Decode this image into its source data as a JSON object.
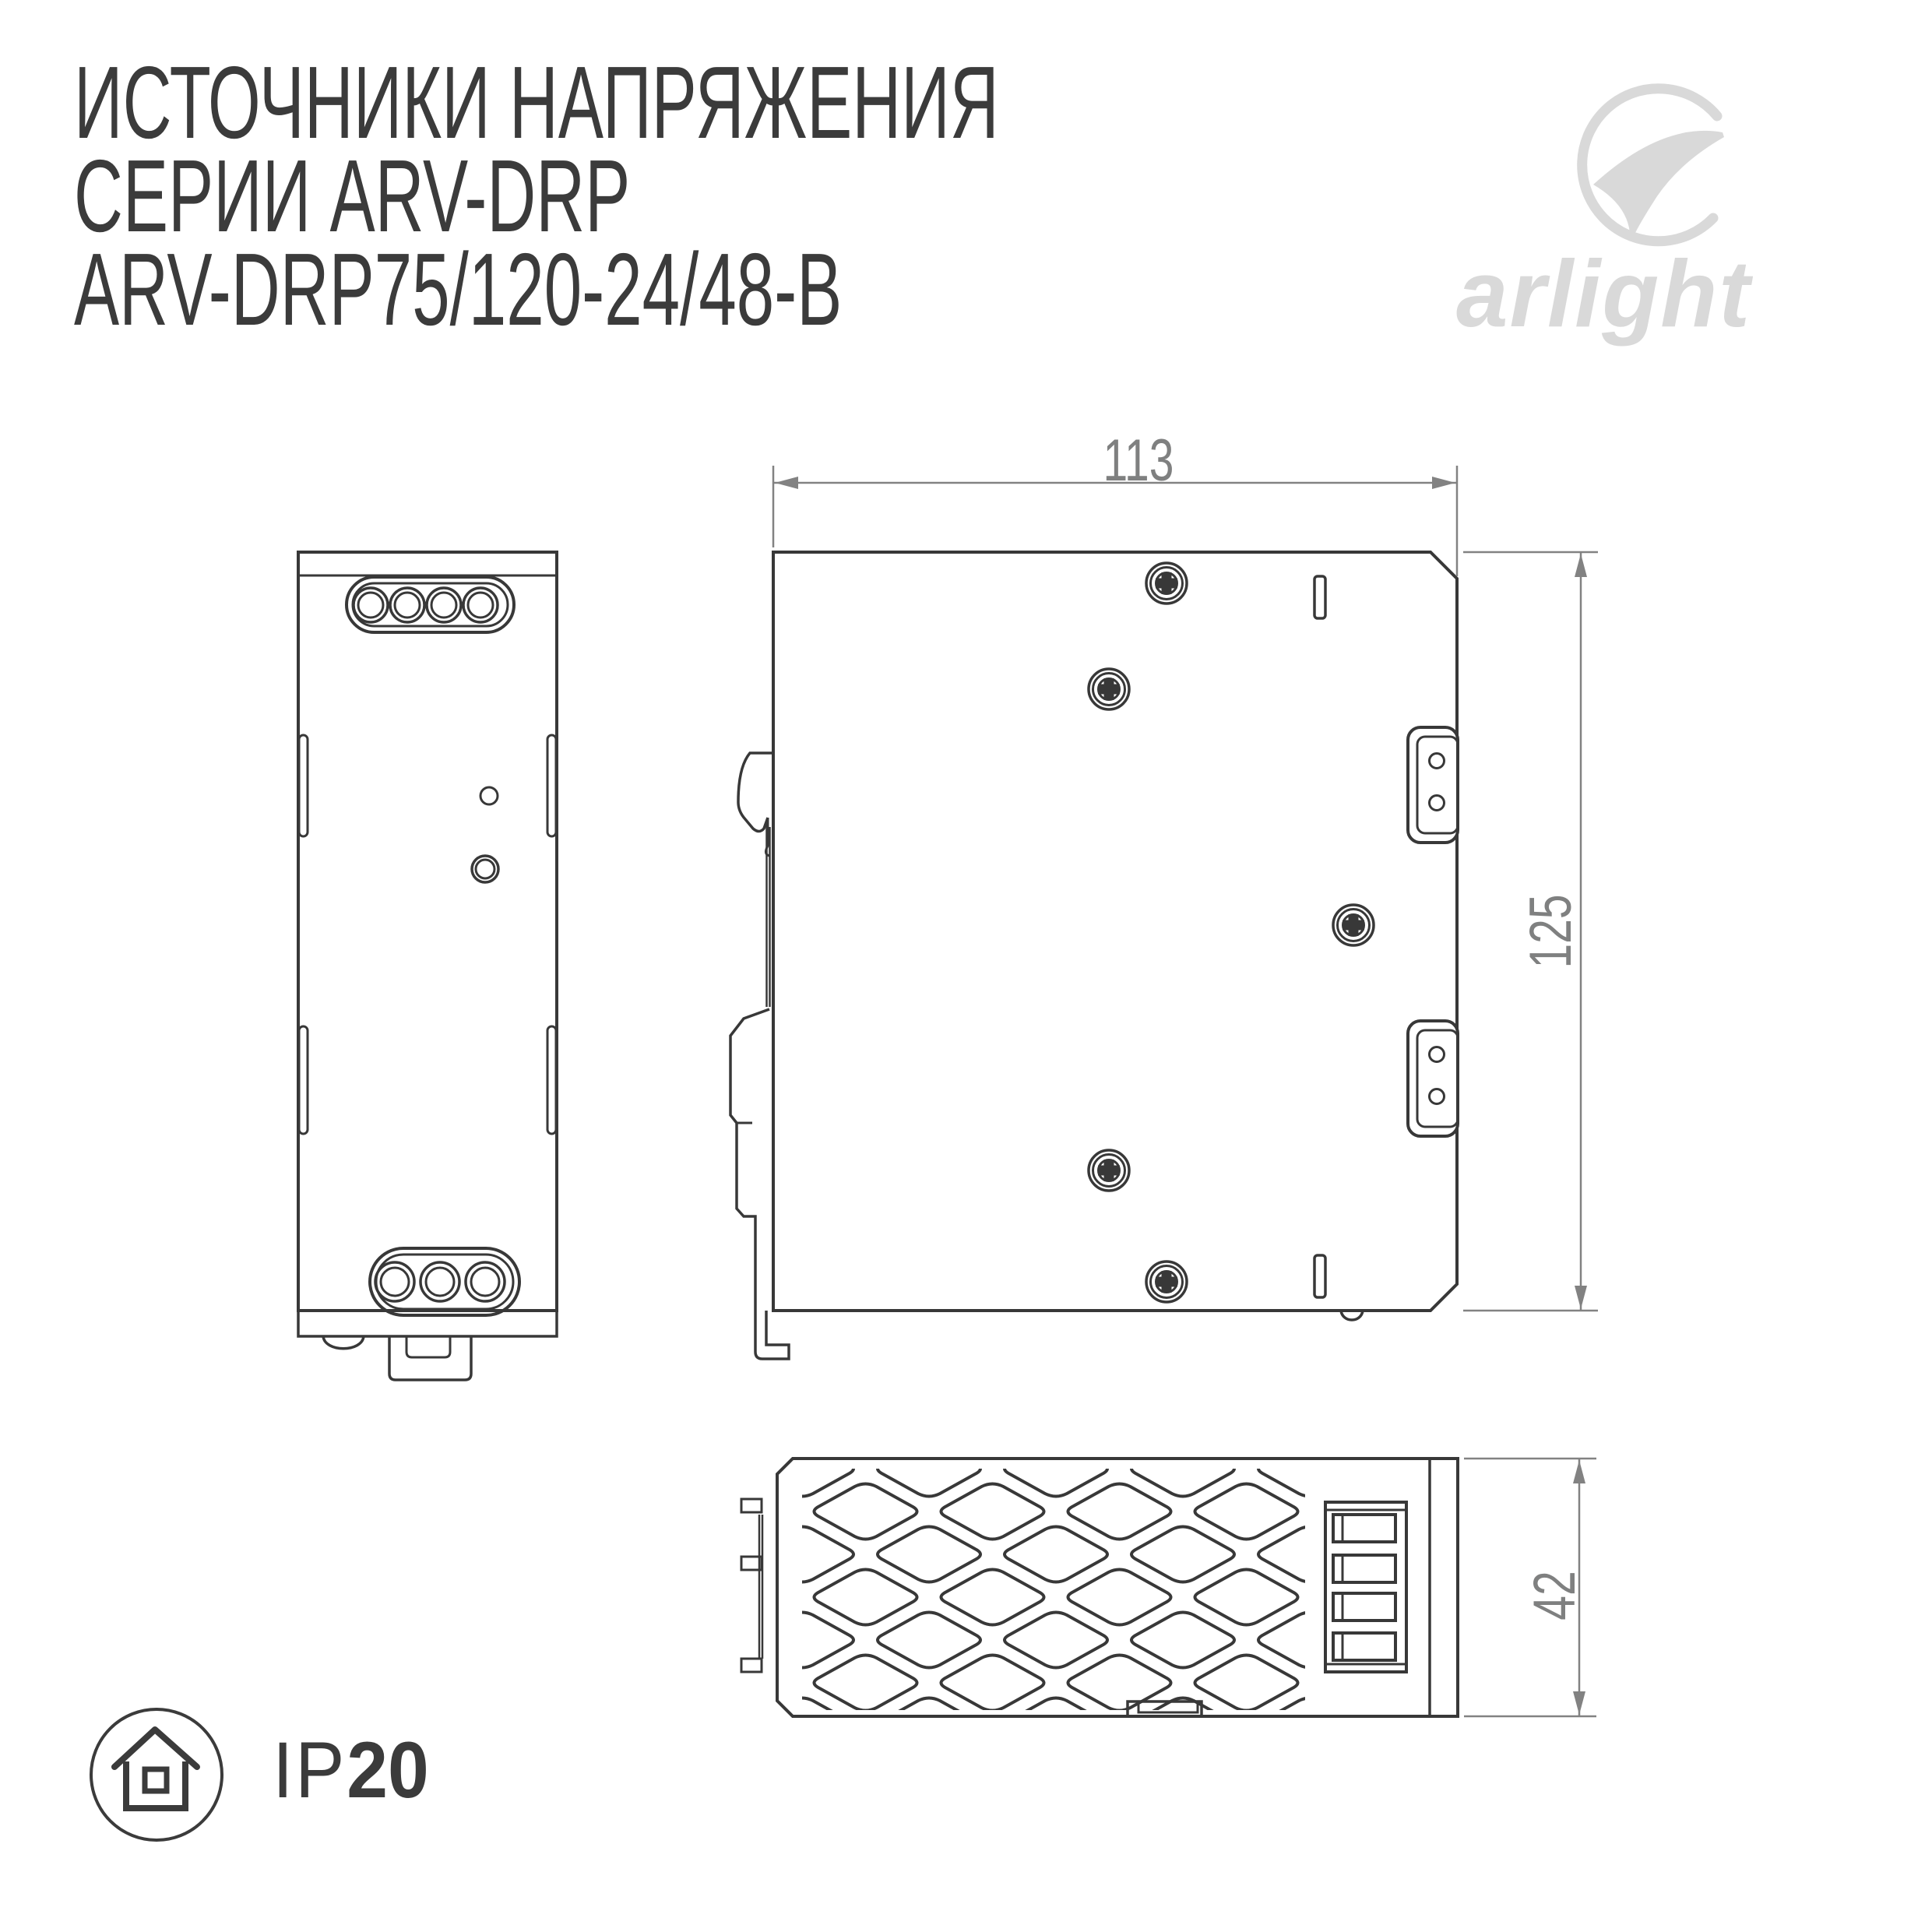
{
  "title": {
    "line1": "ИСТОЧНИКИ НАПРЯЖЕНИЯ",
    "line2": "СЕРИИ ARV-DRP",
    "line3": "ARV-DRP75/120-24/48-B"
  },
  "logo": {
    "brand": "arlight"
  },
  "ip_badge": {
    "prefix": "IP",
    "value": "20"
  },
  "dimensions": {
    "width_mm": "113",
    "height_mm": "125",
    "depth_mm": "42"
  },
  "colors": {
    "line": "#383838",
    "dimension": "#828282",
    "logo_gray": "#d9d9d9",
    "background": "#ffffff"
  }
}
